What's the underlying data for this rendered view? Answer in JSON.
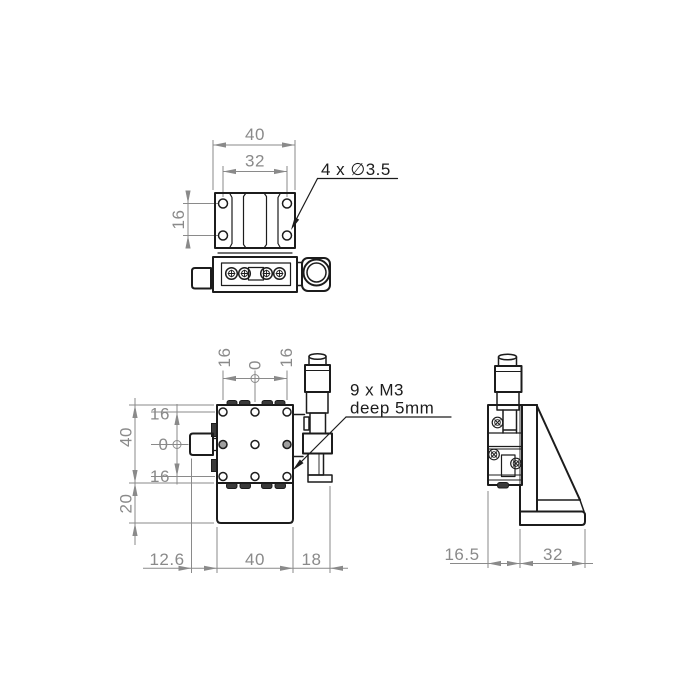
{
  "meta": {
    "background": "#ffffff",
    "line_color": "#1c1c1c",
    "dim_color": "#8a8a8a",
    "dark_fill": "#3a3a3a",
    "hole_shaded": "#9f9f9f"
  },
  "views": {
    "top": {
      "label": "top-view",
      "dims": {
        "overall_width": "40",
        "hole_spacing_x": "32",
        "hole_spacing_y": "16"
      },
      "callout_holes": "4 x ∅3.5"
    },
    "front": {
      "label": "front-view",
      "dims": {
        "top_row": [
          "16",
          "0",
          "16"
        ],
        "left_outer": [
          "40",
          "20"
        ],
        "left_inner": [
          "16",
          "0",
          "16"
        ],
        "bottom_row": [
          "12.6",
          "40",
          "18"
        ]
      },
      "callout_m3_line1": "9 x M3",
      "callout_m3_line2": "deep 5mm"
    },
    "side": {
      "label": "side-view",
      "dims": {
        "bottom_row": [
          "16.5",
          "32"
        ]
      }
    }
  }
}
